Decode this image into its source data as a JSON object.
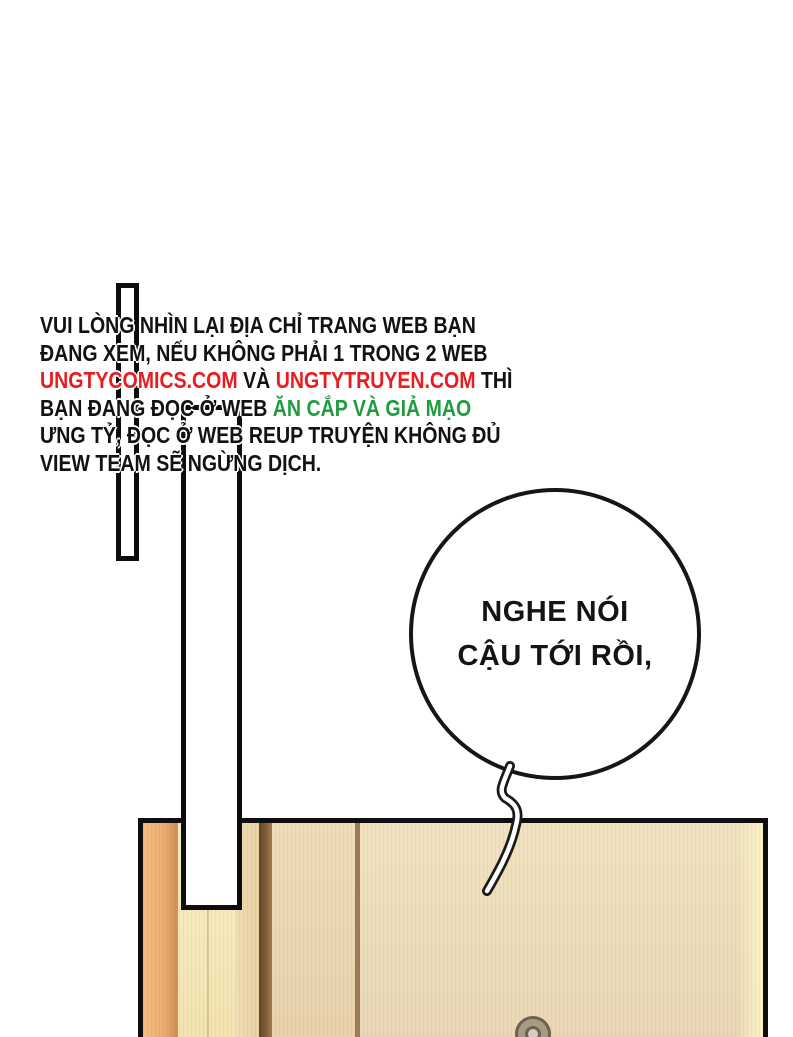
{
  "page": {
    "kind": "comic-page",
    "background": "#ffffff"
  },
  "colors": {
    "link_red": "#ea1c1f",
    "warning_green": "#1f9d3e",
    "ink_black": "#121212",
    "door_orange": "#eeae72",
    "door_cream": "#f6eabc",
    "door_tan": "#ead8b8",
    "door_dark_stripe": "#7c5a36"
  },
  "warning_note": {
    "line1": "VUI LÒNG NHÌN LẠI ĐỊA CHỈ TRANG WEB BẠN",
    "line2": "ĐANG XEM, NẾU KHÔNG PHẢI 1 TRONG 2 WEB",
    "line3_site1": "UNGTYCOMICS.COM",
    "line3_and": " VÀ ",
    "line3_site2": "UNGTYTRUYEN.COM",
    "line3_end": " THÌ",
    "line4_black": "BẠN ĐANG ĐỌC Ở WEB ",
    "line4_green": "ĂN CẮP VÀ GIẢ MẠO",
    "line5": "ƯNG TỶ, ĐỌC Ở WEB REUP TRUYỆN KHÔNG ĐỦ",
    "line6": "VIEW TEAM SẼ NGỪNG DỊCH."
  },
  "speech_bubble": {
    "line1": "NGHE NÓI",
    "line2": "CẬU TỚI RỒI,"
  },
  "icons": {
    "door_keyhole": "concentric-circle-knob"
  }
}
